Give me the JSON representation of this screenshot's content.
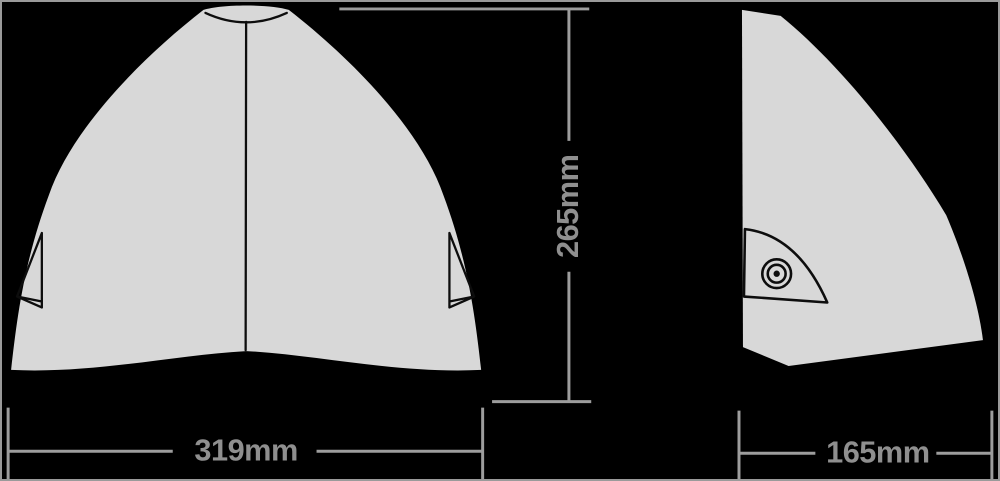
{
  "colors": {
    "background": "#000000",
    "shape_fill": "#d8d8d8",
    "outline": "#0d0d0d",
    "dimension_line": "#9d9d9d",
    "dimension_text": "#8f8f8f",
    "frame": "#9a9a9a"
  },
  "dimensions": {
    "height": {
      "label": "265mm"
    },
    "width": {
      "label": "319mm"
    },
    "depth": {
      "label": "165mm"
    }
  }
}
